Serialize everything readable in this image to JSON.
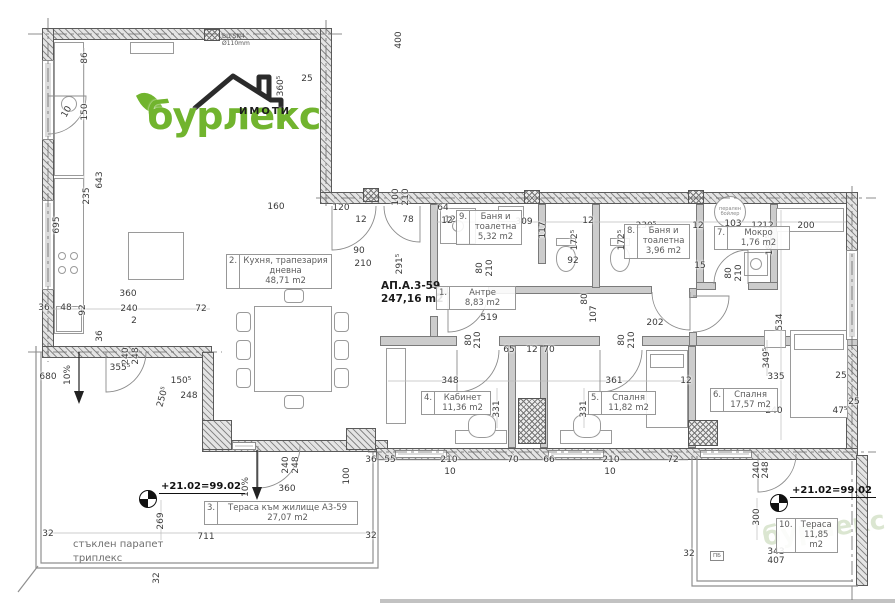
{
  "logo": {
    "brand": "бурлекс",
    "sub": "ИМОТИ"
  },
  "apartment": {
    "id": "АП.А.3-59",
    "area": "247,16 m2"
  },
  "annotations": {
    "elevation": "+21.02=99.02",
    "parapet_line1": "стъклен парапет",
    "parapet_line2": "триплекс",
    "pipe_line1": "ВЦ SN4",
    "pipe_line2": "Ø110mm",
    "boiler_line1": "перален",
    "boiler_line2": "бойлер",
    "pb": "ПБ"
  },
  "rooms": [
    {
      "num": "1.",
      "name": "Антре",
      "area": "8,83 m2",
      "x": 436,
      "y": 286,
      "w": 80
    },
    {
      "num": "2.",
      "name": "Кухня, трапезария дневна",
      "area": "48,71 m2",
      "x": 226,
      "y": 254,
      "w": 106
    },
    {
      "num": "3.",
      "name": "Тераса към жилище А3-59",
      "area": "27,07 m2",
      "x": 204,
      "y": 501,
      "w": 154
    },
    {
      "num": "4.",
      "name": "Кабинет",
      "area": "11,36 m2",
      "x": 421,
      "y": 391,
      "w": 70
    },
    {
      "num": "5.",
      "name": "Спалня",
      "area": "11,82 m2",
      "x": 588,
      "y": 391,
      "w": 68
    },
    {
      "num": "6.",
      "name": "Спалня",
      "area": "17,57 m2",
      "x": 710,
      "y": 388,
      "w": 68
    },
    {
      "num": "7.",
      "name": "Мокро",
      "area": "1,76 m2",
      "x": 714,
      "y": 226,
      "w": 76
    },
    {
      "num": "8.",
      "name": "Баня и тоалетна",
      "area": "3,96 m2",
      "x": 624,
      "y": 224,
      "w": 66
    },
    {
      "num": "9.",
      "name": "Баня и тоалетна",
      "area": "5,32 m2",
      "x": 456,
      "y": 210,
      "w": 66
    },
    {
      "num": "10.",
      "name": "Тераса",
      "area": "11,85 m2",
      "x": 776,
      "y": 518,
      "w": 62
    }
  ],
  "dims": [
    {
      "t": "86",
      "x": 85,
      "y": 58,
      "r": -90
    },
    {
      "t": "150",
      "x": 85,
      "y": 112,
      "r": -90
    },
    {
      "t": "10",
      "x": 67,
      "y": 112,
      "r": -60
    },
    {
      "t": "643",
      "x": 100,
      "y": 180,
      "r": -90
    },
    {
      "t": "235",
      "x": 87,
      "y": 196,
      "r": -90
    },
    {
      "t": "695",
      "x": 57,
      "y": 225,
      "r": -90
    },
    {
      "t": "360⁵",
      "x": 281,
      "y": 86,
      "r": -90
    },
    {
      "t": "25",
      "x": 307,
      "y": 79
    },
    {
      "t": "400",
      "x": 399,
      "y": 40,
      "r": -90
    },
    {
      "t": "160",
      "x": 276,
      "y": 207
    },
    {
      "t": "120",
      "x": 341,
      "y": 208
    },
    {
      "t": "12",
      "x": 361,
      "y": 220
    },
    {
      "t": "100",
      "x": 396,
      "y": 197,
      "r": -90
    },
    {
      "t": "210",
      "x": 406,
      "y": 197,
      "r": -90
    },
    {
      "t": "78",
      "x": 408,
      "y": 220
    },
    {
      "t": "64",
      "x": 443,
      "y": 208
    },
    {
      "t": "12",
      "x": 450,
      "y": 220
    },
    {
      "t": "90",
      "x": 359,
      "y": 251
    },
    {
      "t": "210",
      "x": 363,
      "y": 264
    },
    {
      "t": "291⁵",
      "x": 400,
      "y": 264,
      "r": -90
    },
    {
      "t": "12",
      "x": 447,
      "y": 221
    },
    {
      "t": "309",
      "x": 524,
      "y": 222
    },
    {
      "t": "12",
      "x": 588,
      "y": 221
    },
    {
      "t": "117",
      "x": 543,
      "y": 230,
      "r": -90
    },
    {
      "t": "172⁵",
      "x": 575,
      "y": 240,
      "r": -90
    },
    {
      "t": "92",
      "x": 573,
      "y": 261
    },
    {
      "t": "80",
      "x": 480,
      "y": 268,
      "r": -90
    },
    {
      "t": "210",
      "x": 490,
      "y": 268,
      "r": -90
    },
    {
      "t": "230⁵",
      "x": 646,
      "y": 226
    },
    {
      "t": "12",
      "x": 698,
      "y": 226
    },
    {
      "t": "103",
      "x": 733,
      "y": 224
    },
    {
      "t": "12",
      "x": 768,
      "y": 226
    },
    {
      "t": "200",
      "x": 806,
      "y": 226
    },
    {
      "t": "12",
      "x": 757,
      "y": 226
    },
    {
      "t": "184⁵",
      "x": 770,
      "y": 245,
      "r": -90
    },
    {
      "t": "172⁵",
      "x": 622,
      "y": 240,
      "r": -90
    },
    {
      "t": "15",
      "x": 700,
      "y": 266
    },
    {
      "t": "80",
      "x": 729,
      "y": 273,
      "r": -90
    },
    {
      "t": "210",
      "x": 739,
      "y": 273,
      "r": -90
    },
    {
      "t": "107",
      "x": 594,
      "y": 314,
      "r": -90
    },
    {
      "t": "80",
      "x": 585,
      "y": 299,
      "r": -90
    },
    {
      "t": "202",
      "x": 655,
      "y": 323
    },
    {
      "t": "519",
      "x": 489,
      "y": 318
    },
    {
      "t": "80",
      "x": 469,
      "y": 340,
      "r": -90
    },
    {
      "t": "210",
      "x": 478,
      "y": 340,
      "r": -90
    },
    {
      "t": "65",
      "x": 509,
      "y": 350
    },
    {
      "t": "12",
      "x": 532,
      "y": 350
    },
    {
      "t": "70",
      "x": 549,
      "y": 350
    },
    {
      "t": "80",
      "x": 622,
      "y": 340,
      "r": -90
    },
    {
      "t": "210",
      "x": 632,
      "y": 340,
      "r": -90
    },
    {
      "t": "348",
      "x": 450,
      "y": 381
    },
    {
      "t": "361",
      "x": 614,
      "y": 381
    },
    {
      "t": "12",
      "x": 686,
      "y": 381
    },
    {
      "t": "331",
      "x": 497,
      "y": 409,
      "r": -90
    },
    {
      "t": "331",
      "x": 584,
      "y": 409,
      "r": -90
    },
    {
      "t": "534",
      "x": 780,
      "y": 322,
      "r": -90
    },
    {
      "t": "349⁵",
      "x": 767,
      "y": 358,
      "r": -90
    },
    {
      "t": "335",
      "x": 776,
      "y": 377
    },
    {
      "t": "25",
      "x": 841,
      "y": 376
    },
    {
      "t": "240",
      "x": 774,
      "y": 411
    },
    {
      "t": "47⁵",
      "x": 840,
      "y": 411
    },
    {
      "t": "25",
      "x": 854,
      "y": 402
    },
    {
      "t": "36",
      "x": 371,
      "y": 460
    },
    {
      "t": "55",
      "x": 390,
      "y": 460
    },
    {
      "t": "210",
      "x": 449,
      "y": 460
    },
    {
      "t": "70",
      "x": 513,
      "y": 460
    },
    {
      "t": "66",
      "x": 549,
      "y": 460
    },
    {
      "t": "210",
      "x": 611,
      "y": 460
    },
    {
      "t": "72",
      "x": 673,
      "y": 460
    },
    {
      "t": "10",
      "x": 450,
      "y": 472
    },
    {
      "t": "10",
      "x": 610,
      "y": 472
    },
    {
      "t": "360",
      "x": 128,
      "y": 294
    },
    {
      "t": "36",
      "x": 44,
      "y": 308
    },
    {
      "t": "48",
      "x": 66,
      "y": 308
    },
    {
      "t": "92",
      "x": 83,
      "y": 310,
      "r": -90
    },
    {
      "t": "240",
      "x": 129,
      "y": 309
    },
    {
      "t": "72",
      "x": 201,
      "y": 309
    },
    {
      "t": "2",
      "x": 134,
      "y": 321
    },
    {
      "t": "36",
      "x": 100,
      "y": 336,
      "r": -90
    },
    {
      "t": "240",
      "x": 126,
      "y": 356,
      "r": -90
    },
    {
      "t": "248",
      "x": 136,
      "y": 356,
      "r": -90
    },
    {
      "t": "355⁵",
      "x": 120,
      "y": 368
    },
    {
      "t": "680",
      "x": 48,
      "y": 377
    },
    {
      "t": "150⁵",
      "x": 181,
      "y": 381
    },
    {
      "t": "248",
      "x": 189,
      "y": 396
    },
    {
      "t": "250⁵",
      "x": 163,
      "y": 397,
      "r": -75
    },
    {
      "t": "10%",
      "x": 68,
      "y": 375,
      "r": -90
    },
    {
      "t": "240",
      "x": 286,
      "y": 465,
      "r": -90
    },
    {
      "t": "248",
      "x": 296,
      "y": 465,
      "r": -90
    },
    {
      "t": "360",
      "x": 287,
      "y": 489
    },
    {
      "t": "10%",
      "x": 246,
      "y": 487,
      "r": -90
    },
    {
      "t": "100",
      "x": 347,
      "y": 476,
      "r": -90
    },
    {
      "t": "269",
      "x": 161,
      "y": 521,
      "r": -90
    },
    {
      "t": "711",
      "x": 206,
      "y": 537
    },
    {
      "t": "32",
      "x": 371,
      "y": 536
    },
    {
      "t": "32",
      "x": 48,
      "y": 534
    },
    {
      "t": "32",
      "x": 157,
      "y": 578,
      "r": -90
    },
    {
      "t": "300",
      "x": 757,
      "y": 517,
      "r": -90
    },
    {
      "t": "343",
      "x": 776,
      "y": 552
    },
    {
      "t": "407",
      "x": 776,
      "y": 561
    },
    {
      "t": "32",
      "x": 689,
      "y": 554
    },
    {
      "t": "240",
      "x": 757,
      "y": 470,
      "r": -90
    },
    {
      "t": "248",
      "x": 766,
      "y": 470,
      "r": -90
    }
  ]
}
